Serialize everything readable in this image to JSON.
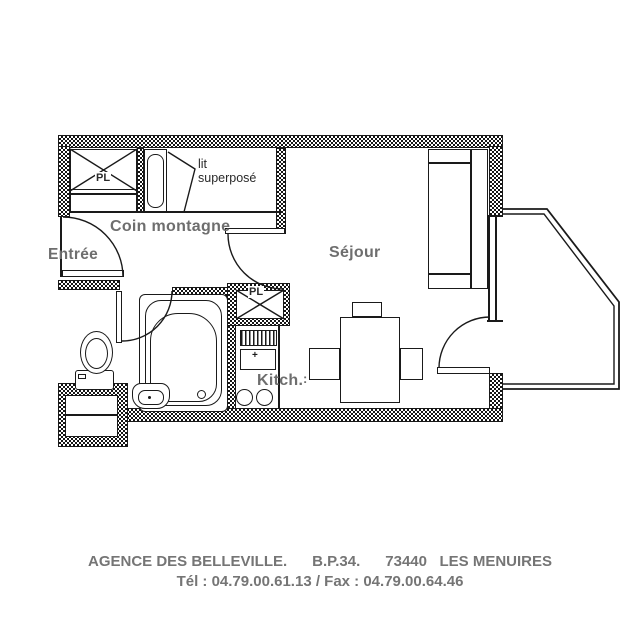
{
  "plan": {
    "labels": {
      "entree": "Entrée",
      "coin_montagne": "Coin montagne",
      "sejour": "Séjour",
      "kitchen": "Kitch.",
      "closet_montagne": "PL",
      "closet_kitchen": "PL",
      "bunk_line1": "lit",
      "bunk_line2": "superposé",
      "kitchen_dots": ":",
      "stove_mark": "+"
    }
  },
  "footer": {
    "line1": "AGENCE DES BELLEVILLE.      B.P.34.      73440   LES MENUIRES",
    "line2": "Tél : 04.79.00.61.13 / Fax : 04.79.00.64.46"
  },
  "colors": {
    "line": "#1a1a1a",
    "room_label": "#6e6e6e",
    "annotation": "#2a2a2a",
    "footer_text": "#757575",
    "wall_dark": "#151515",
    "background": "#ffffff"
  }
}
